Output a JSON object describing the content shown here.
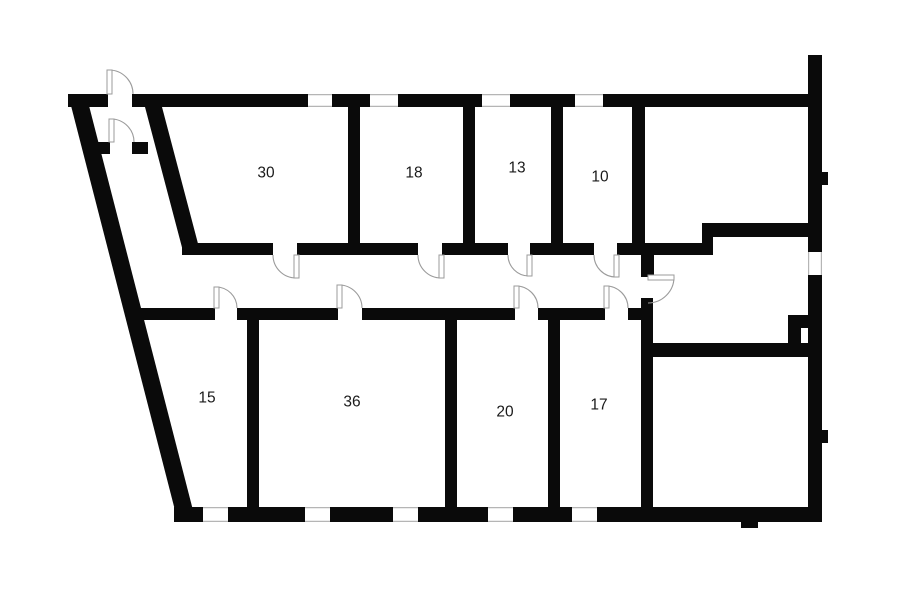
{
  "plan": {
    "canvas": {
      "width": 900,
      "height": 604
    },
    "colors": {
      "background": "#ffffff",
      "wall": "#0a0a0a",
      "door_arc": "#9b9b9b",
      "window_line": "#b5b5b5",
      "label": "#1a1a1a"
    },
    "label_font_size": 15.5,
    "rooms": [
      {
        "label": "30",
        "cx": 266,
        "cy": 173
      },
      {
        "label": "18",
        "cx": 414,
        "cy": 173
      },
      {
        "label": "13",
        "cx": 517,
        "cy": 168
      },
      {
        "label": "10",
        "cx": 600,
        "cy": 177
      },
      {
        "label": "15",
        "cx": 207,
        "cy": 398
      },
      {
        "label": "36",
        "cx": 352,
        "cy": 402
      },
      {
        "label": "20",
        "cx": 505,
        "cy": 412
      },
      {
        "label": "17",
        "cx": 599,
        "cy": 405
      }
    ],
    "slanted_walls": [
      {
        "name": "outer-left-slanted-wall",
        "points": [
          [
            68,
            94
          ],
          [
            86,
            94
          ],
          [
            196,
            522
          ],
          [
            178,
            522
          ]
        ]
      },
      {
        "name": "inner-entry-slanted-wall",
        "points": [
          [
            145,
            107
          ],
          [
            162,
            107
          ],
          [
            201,
            255
          ],
          [
            184,
            255
          ]
        ]
      }
    ],
    "walls": [
      {
        "name": "top-wall-seg-1",
        "rect": [
          68,
          94,
          40,
          13
        ]
      },
      {
        "name": "top-wall-seg-2",
        "rect": [
          132,
          94,
          176,
          13
        ]
      },
      {
        "name": "top-wall-seg-3",
        "rect": [
          332,
          94,
          38,
          13
        ]
      },
      {
        "name": "top-wall-seg-4",
        "rect": [
          398,
          94,
          84,
          13
        ]
      },
      {
        "name": "top-wall-seg-5",
        "rect": [
          510,
          94,
          65,
          13
        ]
      },
      {
        "name": "top-wall-seg-6",
        "rect": [
          603,
          94,
          219,
          13
        ]
      },
      {
        "name": "right-wall-top-stub",
        "rect": [
          808,
          55,
          14,
          39
        ]
      },
      {
        "name": "right-wall-upper",
        "rect": [
          808,
          94,
          14,
          158
        ]
      },
      {
        "name": "right-wall-lower",
        "rect": [
          808,
          275,
          14,
          247
        ]
      },
      {
        "name": "right-wall-bump-upper",
        "rect": [
          819,
          172,
          9,
          13
        ]
      },
      {
        "name": "right-wall-bump-lower",
        "rect": [
          819,
          430,
          9,
          13
        ]
      },
      {
        "name": "bottom-wall-seg-1",
        "rect": [
          174,
          507,
          29,
          15
        ]
      },
      {
        "name": "bottom-wall-seg-2",
        "rect": [
          228,
          507,
          77,
          15
        ]
      },
      {
        "name": "bottom-wall-seg-3",
        "rect": [
          330,
          507,
          63,
          15
        ]
      },
      {
        "name": "bottom-wall-seg-4",
        "rect": [
          418,
          507,
          70,
          15
        ]
      },
      {
        "name": "bottom-wall-seg-5",
        "rect": [
          513,
          507,
          59,
          15
        ]
      },
      {
        "name": "bottom-wall-seg-6",
        "rect": [
          597,
          507,
          225,
          15
        ]
      },
      {
        "name": "bottom-wall-pier",
        "rect": [
          741,
          507,
          17,
          21
        ]
      },
      {
        "name": "vestibule-wall-seg-1",
        "rect": [
          88,
          142,
          22,
          12
        ]
      },
      {
        "name": "vestibule-wall-seg-2",
        "rect": [
          132,
          142,
          16,
          12
        ]
      },
      {
        "name": "corridor-upper-wall-seg-1",
        "rect": [
          182,
          243,
          91,
          12
        ]
      },
      {
        "name": "corridor-upper-wall-seg-2",
        "rect": [
          297,
          243,
          121,
          12
        ]
      },
      {
        "name": "corridor-upper-wall-seg-3",
        "rect": [
          442,
          243,
          66,
          12
        ]
      },
      {
        "name": "corridor-upper-wall-seg-4",
        "rect": [
          530,
          243,
          64,
          12
        ]
      },
      {
        "name": "corridor-upper-wall-seg-5",
        "rect": [
          617,
          243,
          96,
          12
        ]
      },
      {
        "name": "corridor-step-connector",
        "rect": [
          702,
          223,
          11,
          32
        ]
      },
      {
        "name": "upper-right-room-bottom-wall",
        "rect": [
          702,
          223,
          120,
          14
        ]
      },
      {
        "name": "divider-room30-room18",
        "rect": [
          348,
          107,
          12,
          136
        ]
      },
      {
        "name": "divider-room18-room13",
        "rect": [
          463,
          107,
          12,
          136
        ]
      },
      {
        "name": "divider-room13-room10",
        "rect": [
          551,
          107,
          12,
          136
        ]
      },
      {
        "name": "divider-room10-right-room",
        "rect": [
          632,
          107,
          13,
          136
        ]
      },
      {
        "name": "corridor-end-door-stub",
        "rect": [
          641,
          255,
          13,
          22
        ]
      },
      {
        "name": "corridor-lower-wall-seg-1",
        "rect": [
          133,
          308,
          82,
          12
        ]
      },
      {
        "name": "corridor-lower-wall-seg-2",
        "rect": [
          237,
          308,
          101,
          12
        ]
      },
      {
        "name": "corridor-lower-wall-seg-3",
        "rect": [
          362,
          308,
          153,
          12
        ]
      },
      {
        "name": "corridor-lower-wall-seg-4",
        "rect": [
          538,
          308,
          67,
          12
        ]
      },
      {
        "name": "corridor-lower-wall-seg-5",
        "rect": [
          628,
          308,
          14,
          12
        ]
      },
      {
        "name": "divider-room15-room36",
        "rect": [
          247,
          320,
          12,
          187
        ]
      },
      {
        "name": "divider-room36-room20",
        "rect": [
          445,
          320,
          12,
          187
        ]
      },
      {
        "name": "divider-room20-room17",
        "rect": [
          548,
          320,
          12,
          187
        ]
      },
      {
        "name": "bottom-right-room-left-wall",
        "rect": [
          641,
          298,
          12,
          214
        ]
      },
      {
        "name": "bottom-right-room-top-wall",
        "rect": [
          653,
          343,
          169,
          14
        ]
      },
      {
        "name": "niche-wall-horizontal",
        "rect": [
          788,
          315,
          34,
          13
        ]
      },
      {
        "name": "niche-wall-vertical",
        "rect": [
          788,
          315,
          13,
          30
        ]
      }
    ],
    "windows": [
      {
        "name": "window-top-1",
        "rect": [
          308,
          94,
          24,
          13
        ],
        "orient": "h"
      },
      {
        "name": "window-top-2",
        "rect": [
          370,
          94,
          28,
          13
        ],
        "orient": "h"
      },
      {
        "name": "window-top-3",
        "rect": [
          482,
          94,
          28,
          13
        ],
        "orient": "h"
      },
      {
        "name": "window-top-4",
        "rect": [
          575,
          94,
          28,
          13
        ],
        "orient": "h"
      },
      {
        "name": "window-bottom-1",
        "rect": [
          203,
          507,
          25,
          15
        ],
        "orient": "h"
      },
      {
        "name": "window-bottom-2",
        "rect": [
          305,
          507,
          25,
          15
        ],
        "orient": "h"
      },
      {
        "name": "window-bottom-3",
        "rect": [
          393,
          507,
          25,
          15
        ],
        "orient": "h"
      },
      {
        "name": "window-bottom-4",
        "rect": [
          488,
          507,
          25,
          15
        ],
        "orient": "h"
      },
      {
        "name": "window-bottom-5",
        "rect": [
          572,
          507,
          25,
          15
        ],
        "orient": "h"
      },
      {
        "name": "opening-right-wall",
        "rect": [
          808,
          252,
          14,
          23
        ],
        "orient": "v"
      }
    ],
    "doors": [
      {
        "name": "door-entrance",
        "hinge": [
          109,
          94
        ],
        "r": 24,
        "a1": -90,
        "a2": 0,
        "sweep": 1,
        "leaf": [
          107,
          70,
          5,
          24
        ]
      },
      {
        "name": "door-vestibule-inner",
        "hinge": [
          111,
          142
        ],
        "r": 23,
        "a1": -90,
        "a2": 0,
        "sweep": 1,
        "leaf": [
          109,
          119,
          5,
          23
        ]
      },
      {
        "name": "door-room-30",
        "hinge": [
          296,
          255
        ],
        "r": 23,
        "a1": 180,
        "a2": 90,
        "sweep": 0,
        "leaf": [
          294,
          255,
          5,
          23
        ]
      },
      {
        "name": "door-room-18",
        "hinge": [
          441,
          255
        ],
        "r": 23,
        "a1": 180,
        "a2": 90,
        "sweep": 0,
        "leaf": [
          439,
          255,
          5,
          23
        ]
      },
      {
        "name": "door-room-13",
        "hinge": [
          529,
          255
        ],
        "r": 21,
        "a1": 180,
        "a2": 90,
        "sweep": 0,
        "leaf": [
          527,
          255,
          5,
          21
        ]
      },
      {
        "name": "door-room-10",
        "hinge": [
          616,
          255
        ],
        "r": 22,
        "a1": 180,
        "a2": 90,
        "sweep": 0,
        "leaf": [
          614,
          255,
          5,
          22
        ]
      },
      {
        "name": "door-corridor-end",
        "hinge": [
          648,
          277
        ],
        "r": 26,
        "a1": 0,
        "a2": 90,
        "sweep": 1,
        "leaf": [
          648,
          275,
          26,
          5
        ]
      },
      {
        "name": "door-room-15",
        "hinge": [
          216,
          308
        ],
        "r": 21,
        "a1": -90,
        "a2": 0,
        "sweep": 1,
        "leaf": [
          214,
          287,
          5,
          21
        ]
      },
      {
        "name": "door-room-36",
        "hinge": [
          339,
          308
        ],
        "r": 23,
        "a1": -90,
        "a2": 0,
        "sweep": 1,
        "leaf": [
          337,
          285,
          5,
          23
        ]
      },
      {
        "name": "door-room-20",
        "hinge": [
          516,
          308
        ],
        "r": 22,
        "a1": -90,
        "a2": 0,
        "sweep": 1,
        "leaf": [
          514,
          286,
          5,
          22
        ]
      },
      {
        "name": "door-room-17",
        "hinge": [
          606,
          308
        ],
        "r": 22,
        "a1": -90,
        "a2": 0,
        "sweep": 1,
        "leaf": [
          604,
          286,
          5,
          22
        ]
      }
    ]
  }
}
